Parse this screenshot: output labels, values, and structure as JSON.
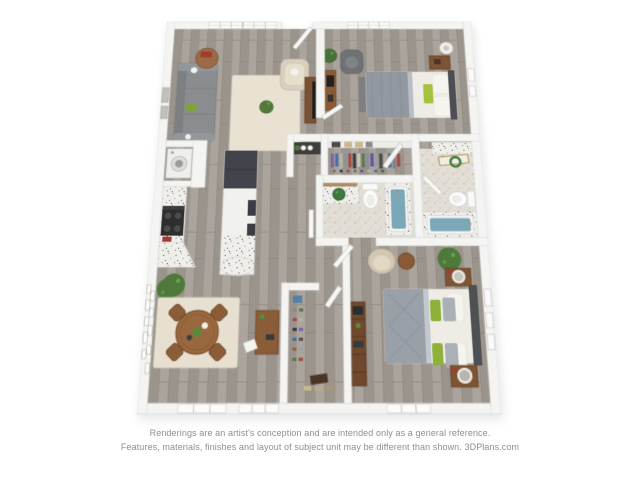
{
  "disclaimer": {
    "line1": "Renderings are an artist's conception and are intended only as a general reference.",
    "line2": "Features, materials, finishes and layout of subject unit may be different than shown. 3DPlans.com"
  },
  "floorplan": {
    "type": "3d-rendered-floor-plan",
    "view": "top-down-perspective",
    "unit_description": "2 bedroom / 2 bathroom apartment",
    "rooms": [
      {
        "name": "living-room",
        "furniture": [
          "sectional-sofa",
          "cream-accent-chair",
          "round-side-table",
          "area-rug",
          "potted-plant",
          "tv-console",
          "wall-frames"
        ]
      },
      {
        "name": "bedroom-1",
        "furniture": [
          "bed-gray-duvet-green-pillow",
          "desk",
          "office-chair",
          "nightstand",
          "floor-lamp",
          "potted-plant",
          "wall-frames",
          "window"
        ]
      },
      {
        "name": "kitchen",
        "furniture": [
          "l-counter-granite",
          "range",
          "refrigerator",
          "island-granite",
          "laundry-closet-washer",
          "potted-plant",
          "pantry-canisters"
        ]
      },
      {
        "name": "walk-in-closet-1",
        "furniture": [
          "hanging-clothes",
          "shelf-baskets",
          "shoe-row",
          "mirror-door"
        ]
      },
      {
        "name": "bathroom-1",
        "furniture": [
          "vanity-vessel-sink",
          "leaning-mirror",
          "toilet",
          "bathtub-blue-water"
        ]
      },
      {
        "name": "bathroom-2",
        "furniture": [
          "granite-vanity",
          "gold-mirror",
          "green-wreath",
          "toilet",
          "bathtub-blue-water"
        ]
      },
      {
        "name": "dining-area",
        "furniture": [
          "round-wood-table",
          "four-wood-chairs",
          "area-rug",
          "console-desk",
          "gallery-wall-frames",
          "potted-plant",
          "windows"
        ]
      },
      {
        "name": "walk-in-closet-2",
        "furniture": [
          "shoe-rows",
          "folded-clothes",
          "storage-box"
        ]
      },
      {
        "name": "bedroom-2",
        "furniture": [
          "bed-gray-duvet-green-pillows",
          "two-nightstands",
          "bookshelf",
          "accent-chair",
          "round-side-table",
          "potted-plant",
          "wall-frames",
          "window"
        ]
      },
      {
        "name": "entry-hallway",
        "furniture": [
          "entry-door"
        ]
      }
    ],
    "colors": {
      "background": "#ffffff",
      "wall": "#f4f4f2",
      "floor_wood": "#a6a099",
      "bathroom_tile": "#e2ded6",
      "tub_water": "#7aa8b8",
      "accent_green": "#8fb13c",
      "wood_brown": "#8a5c37",
      "sofa_gray": "#8a8d8f",
      "rug_cream": "#e9e2d3",
      "disclaimer_text": "#8e8e8e"
    }
  }
}
